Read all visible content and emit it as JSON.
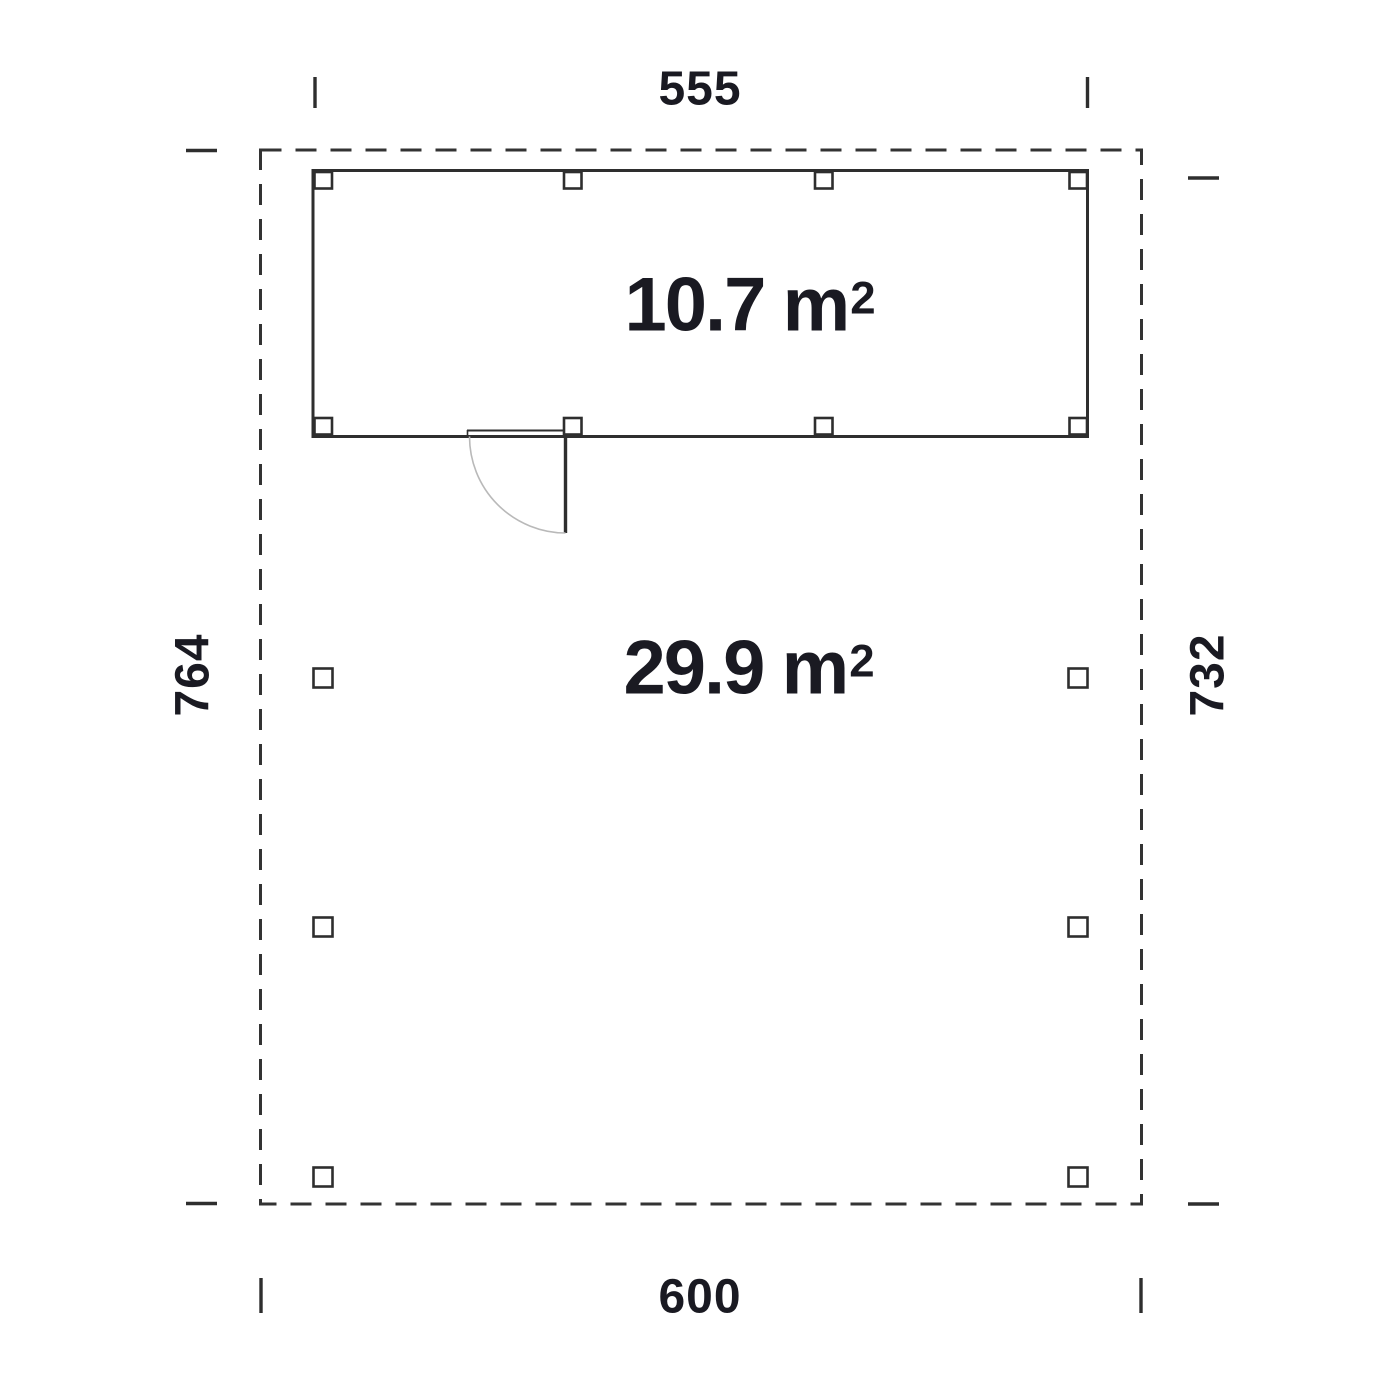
{
  "plan": {
    "dimensions": {
      "top": "555",
      "bottom": "600",
      "left": "764",
      "right": "732"
    },
    "areas": {
      "room": {
        "value": "10.7",
        "unit": "m",
        "exponent": "2"
      },
      "carport": {
        "value": "29.9",
        "unit": "m",
        "exponent": "2"
      }
    }
  },
  "colors": {
    "line": "#2e2e2e",
    "dash": "#333333",
    "text": "#1a1a22",
    "arc": "#b9b9b9",
    "background": "#ffffff"
  }
}
